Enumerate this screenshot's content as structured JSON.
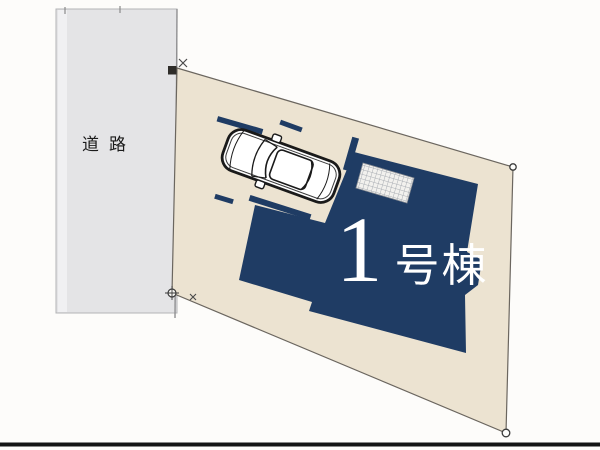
{
  "site": {
    "road_label": "道路",
    "building_number": "1",
    "building_suffix": "号棟",
    "building_full_label": "1号棟"
  },
  "colors": {
    "background": "#fdfcfa",
    "road": "#e4e4e6",
    "road_edge": "#9b9b9d",
    "plot": "#ece3d1",
    "plot_edge": "#6b665f",
    "navy": "#1f3c64",
    "hatch_bg": "#f2f1ee",
    "hatch_line": "#a9adb3",
    "car_stroke": "#1a1a1a",
    "bottom_rule": "#141414"
  }
}
